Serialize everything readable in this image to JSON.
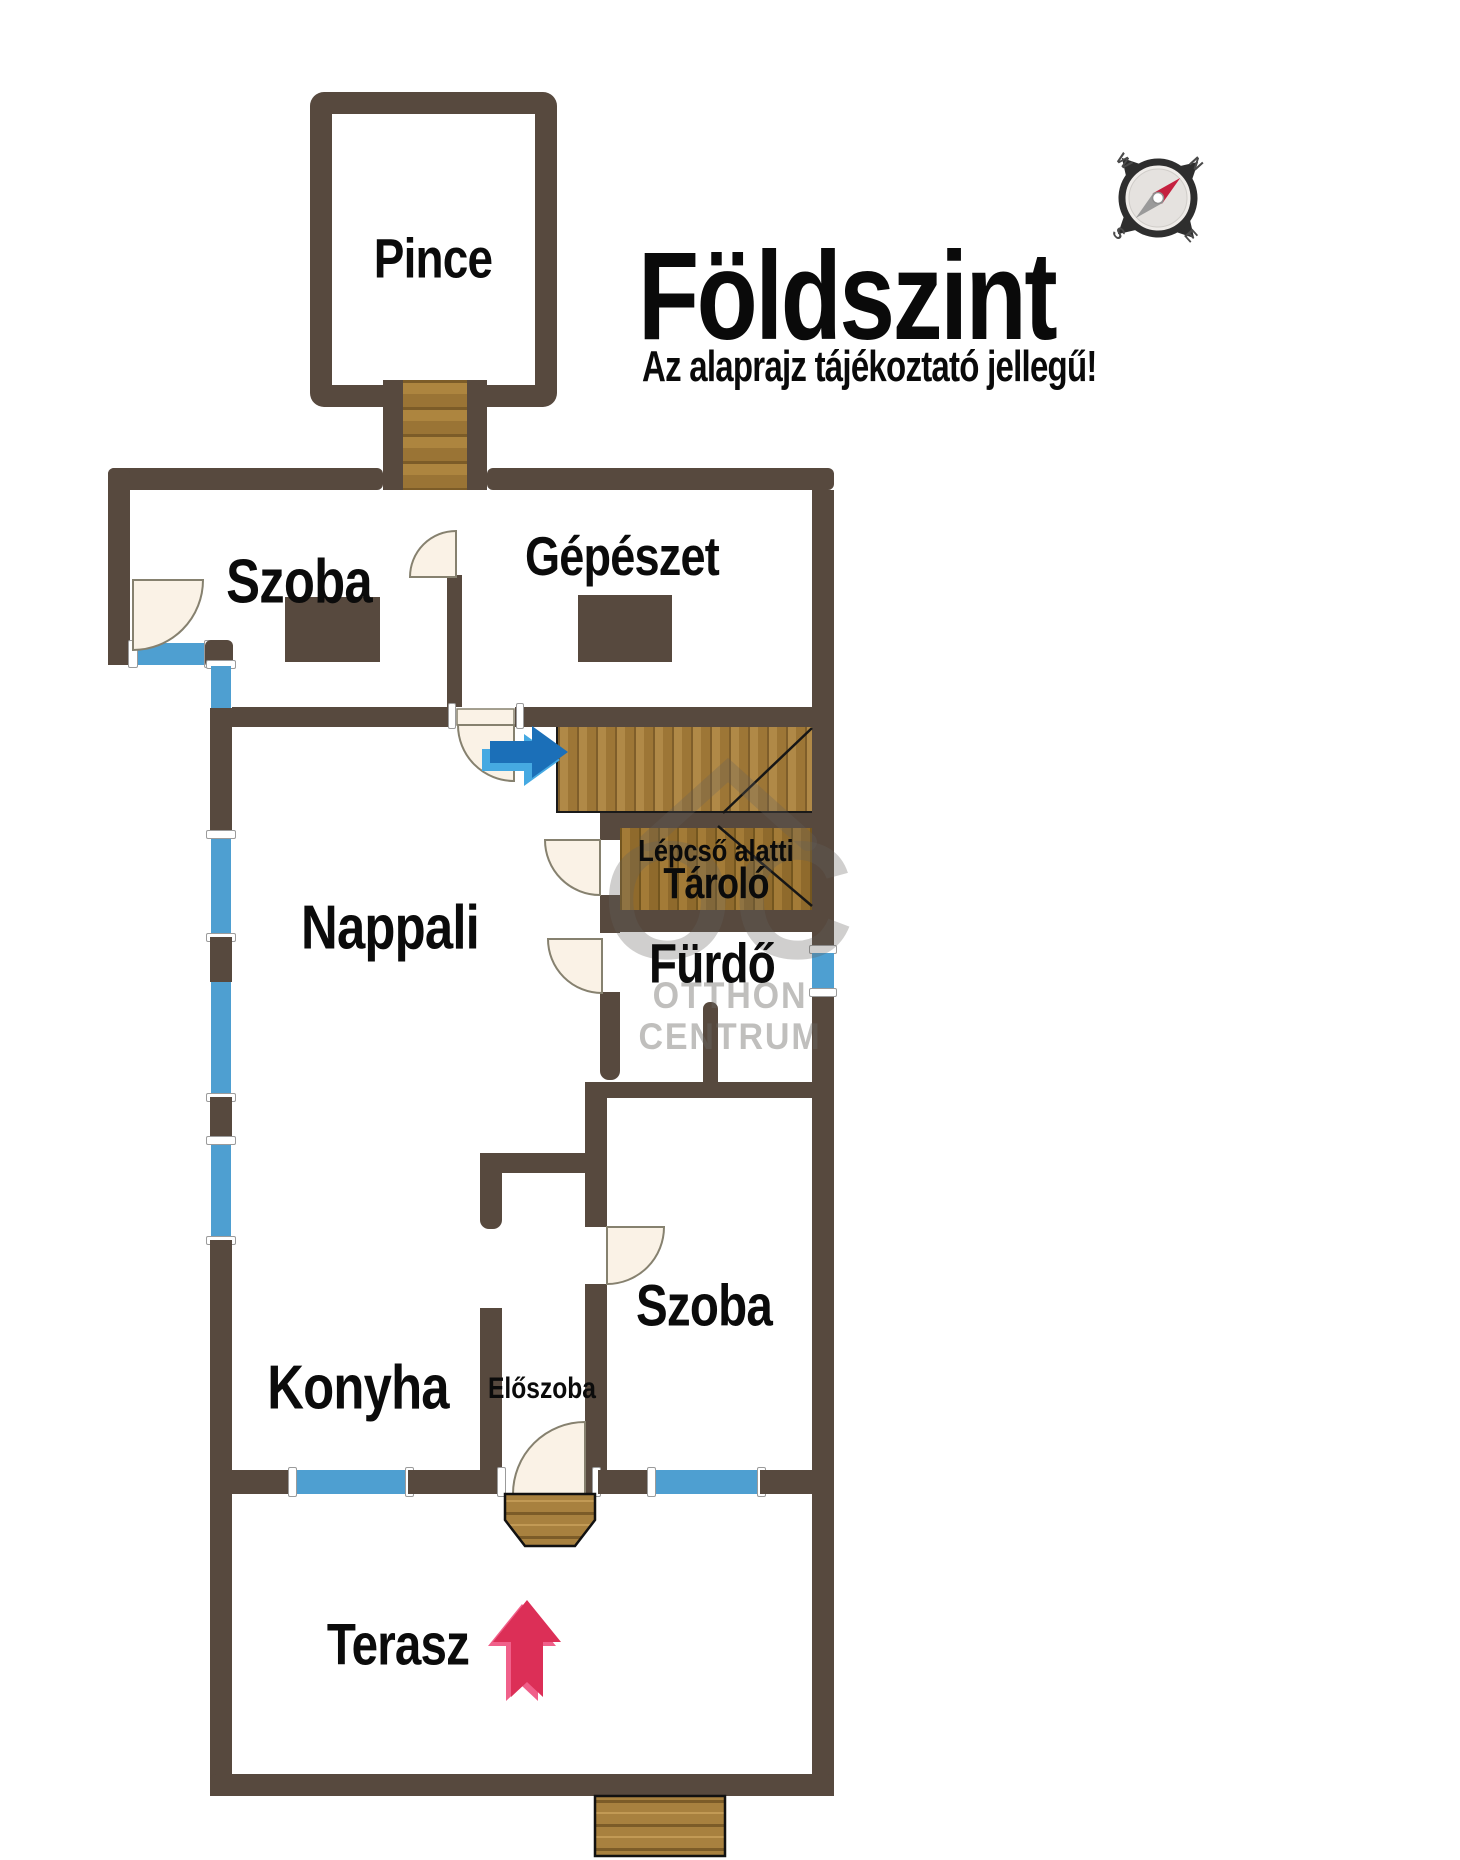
{
  "title": {
    "main": "Földszint",
    "subtitle": "Az alaprajz tájékoztató jellegű!"
  },
  "rooms": {
    "pince": "Pince",
    "szoba_top": "Szoba",
    "gepeszet": "Gépészet",
    "nappali": "Nappali",
    "tarolo_line1": "Lépcső alatti",
    "tarolo_line2": "Tároló",
    "furdo": "Fürdő",
    "konyha": "Konyha",
    "eloszoba": "Előszoba",
    "szoba_lower": "Szoba",
    "terasz": "Terasz"
  },
  "watermark": {
    "logo": "OC",
    "line1": "OTTHON",
    "line2": "CENTRUM"
  },
  "compass": {
    "n": "N",
    "e": "E",
    "s": "S",
    "w": "W"
  },
  "colors": {
    "wall": "#57493E",
    "window_blue": "#4E9FD1",
    "wood": "#A8813F",
    "door_leaf": "#FAF2E6",
    "entry_arrow_red": "#DC2F57",
    "stair_arrow_blue": "#1B6FB8",
    "watermark_gray": "#CCCAC7"
  }
}
